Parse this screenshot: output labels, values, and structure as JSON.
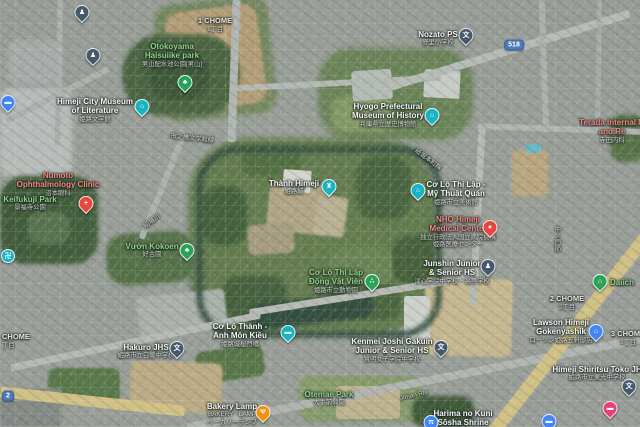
{
  "map": {
    "view": "satellite",
    "place": "Himeji Castle area, Himeji, Japan"
  },
  "colors": {
    "park_label": "#8fd487",
    "medical_label": "#f4877c",
    "poi_label": "#f5f6f4",
    "attraction_pin": "#1ab3c4",
    "park_pin": "#2aa25a",
    "medical_pin": "#e8453c",
    "food_pin": "#f29111",
    "store_pin": "#4285f4",
    "school_pin": "#46596a",
    "hotel_pin": "#e73f77",
    "route_badge": "#4f79b8",
    "major_road": "#e3d08e"
  },
  "route_badges": {
    "r518": "518",
    "r2": "2"
  },
  "icons": {
    "school": "文",
    "temple": "卍",
    "castle": "♜",
    "museum": "⌂",
    "tree": "♣",
    "paw": "∴",
    "fork": "Ψ",
    "cross": "+",
    "dot": "●",
    "torii": "π",
    "bed": "▬",
    "store": "⌂",
    "person": "♟",
    "bridge": "▬"
  },
  "labels": {
    "chome1": {
      "line1": "1 CHOME",
      "sub": "1丁目"
    },
    "otokoyama": {
      "line1": "Otokoyama",
      "line2": "Haisuiike park",
      "sub": "男山配水池公園[男山]"
    },
    "nozato": {
      "line1": "Nozato PS",
      "sub": "野里小学校"
    },
    "lit_museum": {
      "line1": "Himeji City Museum",
      "line2": "of Literature",
      "sub": "姫路文学館"
    },
    "hyogo_museum": {
      "line1": "Hyogo Prefectural",
      "line2": "Museum of History",
      "sub": "兵庫県立歴史博物館"
    },
    "terada": {
      "line1": "Terada Internal M",
      "line2": "and Re",
      "sub": "寺田内科"
    },
    "numoto": {
      "line1": "Numoto",
      "line2": "Ophthalmology Clinic",
      "sub": "沼本眼科"
    },
    "keifukuji": {
      "line1": "Keifukuji Park",
      "sub": "景福寺公園"
    },
    "kokoen": {
      "line1": "Vườn Kokoen",
      "sub": "好古園"
    },
    "castle": {
      "line1": "Thành Himeji",
      "sub": "姫路城"
    },
    "art_museum": {
      "line1": "Cơ Lộ Thị Lập -",
      "line2": "Mỹ Thuật Quán",
      "sub": "姫路市立美術館"
    },
    "nho": {
      "line1": "NHO Himeji",
      "line2": "Medical Center",
      "sub": "独立行政法人国立病院機構",
      "sub2": "姫路医療センター"
    },
    "junshin": {
      "line1": "Junshin Junior",
      "line2": "& Senior HS",
      "sub": "淳心学院中学校・高等学校"
    },
    "zoo": {
      "line1": "Cơ Lộ Thị Lập",
      "line2": "Động Vật Viên",
      "sub": "姫路市立動物園"
    },
    "sakuramon": {
      "line1": "Cơ Lộ Thành -",
      "line2": "Anh Môn Kiều",
      "sub": "姫路城桜門橋"
    },
    "chome_left": {
      "line1": "CHOME",
      "sub": "丁目"
    },
    "hakuro": {
      "line1": "Hakuro JHS",
      "sub": "姫路市立白鷺中学校"
    },
    "kenmei": {
      "line1": "Kenmei Joshi Gakuin",
      "line2": "Junior & Senior HS",
      "sub": "賢明女子学院中学校"
    },
    "chome2": {
      "line1": "2 CHOME",
      "sub": "2丁目"
    },
    "daiichi": {
      "line1": "Daiich"
    },
    "lawson": {
      "line1": "Lawson Himeji",
      "line2": "Gokenyashik",
      "sub": "ローソン姫路五軒邸店"
    },
    "chome3": {
      "line1": "3 CHOME",
      "sub": "3丁目"
    },
    "toko": {
      "line1": "Himeji Shiritsu Toko JH",
      "sub": "姫路市立東光中学校"
    },
    "bakery": {
      "line1": "Bakery Lamp",
      "sub": "BAKERY - LAMP",
      "sub2": "ベーカリーランプ"
    },
    "otemae": {
      "line1": "Otemae Park",
      "sub": "大手前公園"
    },
    "jonan": {
      "line1": "Jonan Rte"
    },
    "sosha": {
      "line1": "Harima no Kuni",
      "line2": "Sōsha Shrine"
    },
    "road_ne": {
      "line1": "砥堀本町線"
    },
    "road_w": {
      "line1": "市之橋文学館線"
    },
    "road_sw": {
      "line1": "船場川"
    },
    "nakanomon": {
      "line1": "中ノ門筋"
    }
  }
}
